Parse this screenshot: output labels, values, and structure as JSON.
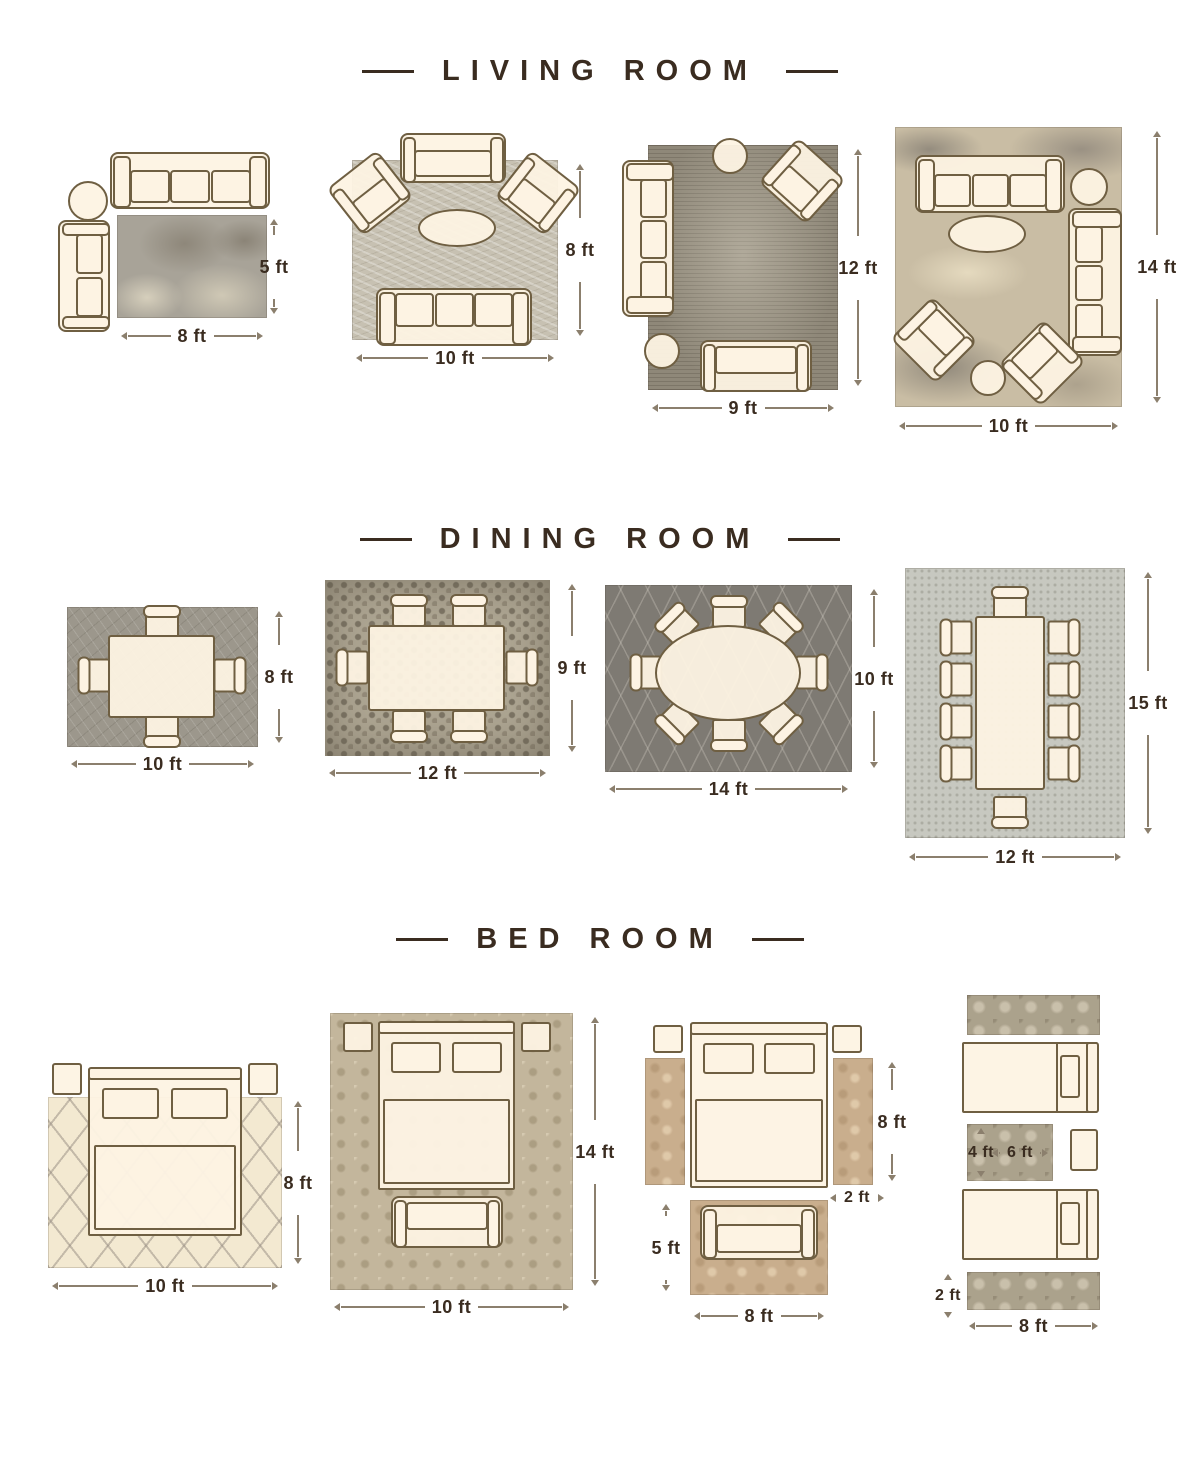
{
  "colors": {
    "background": "#ffffff",
    "title_text": "#3a2c20",
    "dimension_text": "#3a2c20",
    "dimension_line": "#8b7f6d",
    "furniture_fill": "#fdf3e3",
    "furniture_outline": "#6f5f42"
  },
  "sections": [
    {
      "id": "living-room",
      "title": "LIVING ROOM",
      "layouts": [
        {
          "name": "sofa-loveseat-side-table",
          "rug_style": "mottled-gray",
          "furniture": [
            "3-seat sofa",
            "loveseat",
            "round side table"
          ],
          "width": "8 ft",
          "height": "5 ft"
        },
        {
          "name": "sofa-two-armchairs-loveseat",
          "rug_style": "light-scratched-beige",
          "furniture": [
            "loveseat",
            "2 angled armchairs",
            "oval coffee table",
            "3-seat sofa"
          ],
          "width": "10 ft",
          "height": "8 ft"
        },
        {
          "name": "sofa-armchair-loveseat-ottomans",
          "rug_style": "vintage-distressed-gray",
          "furniture": [
            "3-seat sofa",
            "angled armchair",
            "2 round ottomans",
            "loveseat"
          ],
          "width": "9 ft",
          "height": "12 ft"
        },
        {
          "name": "two-sofas-two-armchairs",
          "rug_style": "abstract-tan-gray",
          "furniture": [
            "2 three-seat sofas",
            "2 angled armchairs",
            "oval coffee table",
            "2 round ottomans"
          ],
          "width": "10 ft",
          "height": "14 ft"
        }
      ]
    },
    {
      "id": "dining-room",
      "title": "DINING ROOM",
      "layouts": [
        {
          "name": "table-4-chairs",
          "rug_style": "gray-scratched",
          "furniture": [
            "rectangular table",
            "4 chairs"
          ],
          "width": "10 ft",
          "height": "8 ft"
        },
        {
          "name": "table-6-chairs",
          "rug_style": "mosaic",
          "furniture": [
            "rectangular table",
            "6 chairs"
          ],
          "width": "12 ft",
          "height": "9 ft"
        },
        {
          "name": "oval-table-8-chairs",
          "rug_style": "dark-diamond-lattice",
          "furniture": [
            "oval table",
            "8 chairs"
          ],
          "width": "14 ft",
          "height": "10 ft"
        },
        {
          "name": "long-table-10-chairs",
          "rug_style": "light-speckled",
          "furniture": [
            "long table",
            "10 chairs"
          ],
          "width": "12 ft",
          "height": "15 ft"
        }
      ]
    },
    {
      "id": "bed-room",
      "title": "BED ROOM",
      "layouts": [
        {
          "name": "queen-bed-on-rug",
          "rug_style": "cream-trellis",
          "furniture": [
            "queen bed",
            "2 nightstands"
          ],
          "width": "10 ft",
          "height": "8 ft"
        },
        {
          "name": "queen-bed-bench-full-rug",
          "rug_style": "beige-damask",
          "furniture": [
            "queen bed",
            "2 nightstands",
            "bench"
          ],
          "width": "10 ft",
          "height": "14 ft"
        },
        {
          "name": "bed-side-runners-foot-rug",
          "rug_style": "tan-floral",
          "furniture": [
            "queen bed",
            "2 nightstands",
            "2 side runners",
            "settee on foot rug"
          ],
          "bed_side": "8 ft",
          "runner_width": "2 ft",
          "foot_rug_height": "5 ft",
          "foot_rug_width": "8 ft"
        },
        {
          "name": "twin-beds-runners-between-rug",
          "rug_style": "gray-ornate",
          "furniture": [
            "2 twin beds",
            "nightstand",
            "2 runners",
            "between rug"
          ],
          "between_rug_height": "4 ft",
          "between_rug_width": "6 ft",
          "runner_width": "2 ft",
          "runner_length": "8 ft"
        }
      ]
    }
  ]
}
